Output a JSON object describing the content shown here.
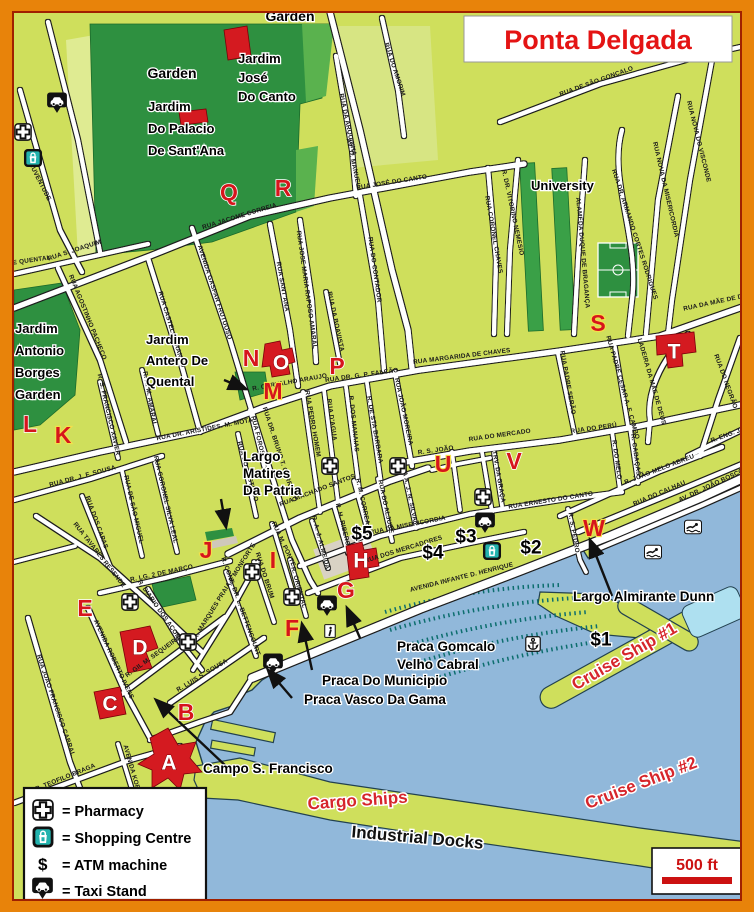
{
  "title": {
    "text": "Ponta Delgada"
  },
  "scale": {
    "text": "500 ft"
  },
  "legend": {
    "dollar": "$",
    "rows": [
      {
        "icon": "pharmacy",
        "text": "= Pharmacy"
      },
      {
        "icon": "shopping",
        "text": "= Shopping Centre"
      },
      {
        "icon": "atm",
        "text": "= ATM machine"
      },
      {
        "icon": "taxi",
        "text": "= Taxi Stand"
      }
    ]
  },
  "colors": {
    "frame_orange": "#e8830a",
    "land": "#cfdf5c",
    "water": "#91b8da",
    "park_dark": "#2e9040",
    "road": "#ffffff",
    "marker_red": "#d6151c",
    "title_red": "#e41414",
    "boat_teal": "#0d6e6e"
  },
  "parks": {
    "garden_top": "Garden",
    "garden_west": "Garden",
    "joseCanto": [
      "Jardim",
      "José",
      "Do Canto"
    ],
    "santana": [
      "Jardim",
      "Do Palacio",
      "De Sant'Ana"
    ],
    "borges": [
      "Jardim",
      "Antonio",
      "Borges",
      "Garden"
    ],
    "antero": [
      "Jardim",
      "Antero De",
      "Quental"
    ],
    "university": "University"
  },
  "places": {
    "matires": [
      "Largo",
      "Matires",
      "Da Patria"
    ],
    "gomcalo": [
      "Praca Gomcalo",
      "Velho Cabral"
    ],
    "municipio": "Praca Do Municipio",
    "vasco": "Praca Vasco Da Gama",
    "campo": "Campo S. Francisco",
    "dunn": "Largo Almirante Dunn",
    "cargo": "Cargo Ships",
    "industrial": "Industrial Docks",
    "cruise1": "Cruise Ship #1",
    "cruise2": "Cruise Ship #2"
  },
  "markers": [
    {
      "t": "A",
      "x": 169,
      "y": 763,
      "s": "w"
    },
    {
      "t": "B",
      "x": 186,
      "y": 712,
      "s": "r"
    },
    {
      "t": "C",
      "x": 110,
      "y": 704,
      "s": "w"
    },
    {
      "t": "D",
      "x": 140,
      "y": 648,
      "s": "w"
    },
    {
      "t": "E",
      "x": 85,
      "y": 608,
      "s": "r"
    },
    {
      "t": "F",
      "x": 292,
      "y": 628,
      "s": "y"
    },
    {
      "t": "G",
      "x": 346,
      "y": 590,
      "s": "r"
    },
    {
      "t": "H",
      "x": 361,
      "y": 561,
      "s": "w"
    },
    {
      "t": "I",
      "x": 273,
      "y": 560,
      "s": "y"
    },
    {
      "t": "J",
      "x": 206,
      "y": 550,
      "s": "y"
    },
    {
      "t": "K",
      "x": 63,
      "y": 435,
      "s": "y"
    },
    {
      "t": "L",
      "x": 30,
      "y": 424,
      "s": "r"
    },
    {
      "t": "M",
      "x": 273,
      "y": 391,
      "s": "y"
    },
    {
      "t": "N",
      "x": 251,
      "y": 358,
      "s": "r"
    },
    {
      "t": "O",
      "x": 281,
      "y": 363,
      "s": "w"
    },
    {
      "t": "P",
      "x": 337,
      "y": 366,
      "s": "r"
    },
    {
      "t": "Q",
      "x": 229,
      "y": 192,
      "s": "r"
    },
    {
      "t": "R",
      "x": 283,
      "y": 188,
      "s": "r"
    },
    {
      "t": "S",
      "x": 598,
      "y": 323,
      "s": "y"
    },
    {
      "t": "T",
      "x": 674,
      "y": 352,
      "s": "w"
    },
    {
      "t": "U",
      "x": 443,
      "y": 464,
      "s": "y"
    },
    {
      "t": "V",
      "x": 514,
      "y": 461,
      "s": "r"
    },
    {
      "t": "W",
      "x": 594,
      "y": 528,
      "s": "y"
    }
  ],
  "atms": [
    {
      "t": "$1",
      "x": 601,
      "y": 640
    },
    {
      "t": "$2",
      "x": 531,
      "y": 548
    },
    {
      "t": "$3",
      "x": 466,
      "y": 537
    },
    {
      "t": "$4",
      "x": 433,
      "y": 553
    },
    {
      "t": "$5",
      "x": 362,
      "y": 534
    }
  ],
  "streets": [
    {
      "t": "AV. D. MANUEL I",
      "x": 352,
      "y": 165,
      "a": 78
    },
    {
      "t": "DA JUVENTUDE",
      "x": 36,
      "y": 178,
      "a": 63
    },
    {
      "t": "E QUENTAL",
      "x": 32,
      "y": 262,
      "a": -8
    },
    {
      "t": "RUA S. JOAQUIM",
      "x": 75,
      "y": 252,
      "a": -18
    },
    {
      "t": "RUA JACOME CORREIA",
      "x": 240,
      "y": 218,
      "a": -17
    },
    {
      "t": "RUA JOSÉ DO CANTO",
      "x": 392,
      "y": 184,
      "a": -9
    },
    {
      "t": "RUA CASTELO BRANCO",
      "x": 170,
      "y": 330,
      "a": 73
    },
    {
      "t": "AVENIDA GASPAR FRUTUOSO",
      "x": 213,
      "y": 293,
      "a": 72
    },
    {
      "t": "RUA SANT'ANA",
      "x": 281,
      "y": 287,
      "a": 80
    },
    {
      "t": "RUA JOSE MARIA RAPOSO AMARAL",
      "x": 305,
      "y": 290,
      "a": 82
    },
    {
      "t": "RUA DA BOAVISTA",
      "x": 334,
      "y": 322,
      "a": 78
    },
    {
      "t": "RUA DO CONTADOR",
      "x": 373,
      "y": 270,
      "a": 82
    },
    {
      "t": "RUA DA ARQUINHA",
      "x": 346,
      "y": 125,
      "a": 78
    },
    {
      "t": "RUA DO AMORIM",
      "x": 393,
      "y": 70,
      "a": 72
    },
    {
      "t": "RUA DE SÃO GONÇALO",
      "x": 597,
      "y": 83,
      "a": -20
    },
    {
      "t": "RUA NOVA DO VISCONDE",
      "x": 697,
      "y": 142,
      "a": 76
    },
    {
      "t": "RUA NOVA DA MISERICORDIA",
      "x": 664,
      "y": 190,
      "a": 77
    },
    {
      "t": "RUA DR. ARMANDO CORTES RODRIGUES",
      "x": 633,
      "y": 235,
      "a": 72
    },
    {
      "t": "R. DR. VITORINO NEMESIO",
      "x": 511,
      "y": 213,
      "a": 78
    },
    {
      "t": "ALAMEDA DUQUE DE BRAGANÇA",
      "x": 581,
      "y": 253,
      "a": 85
    },
    {
      "t": "RUA CORONEL CHAVES",
      "x": 492,
      "y": 235,
      "a": 80
    },
    {
      "t": "RUA MARGARIDA DE CHAVES",
      "x": 462,
      "y": 358,
      "a": -7
    },
    {
      "t": "RUA DR. G. P. FALCÃO",
      "x": 362,
      "y": 377,
      "a": -8
    },
    {
      "t": "R. CARVALHO ARAUJO",
      "x": 290,
      "y": 384,
      "a": -10
    },
    {
      "t": "RUA JOÃO MOREIRA",
      "x": 402,
      "y": 412,
      "a": 78
    },
    {
      "t": "RUA PEDRO HOMEM",
      "x": 311,
      "y": 424,
      "a": 80
    },
    {
      "t": "RUA D'AGUA",
      "x": 330,
      "y": 420,
      "a": 82
    },
    {
      "t": "R. DOS MANAIAS",
      "x": 352,
      "y": 424,
      "a": 84
    },
    {
      "t": "R. DE STA BARBARA",
      "x": 373,
      "y": 430,
      "a": 80
    },
    {
      "t": "RUA FOROS",
      "x": 256,
      "y": 436,
      "a": 76
    },
    {
      "t": "RUA DO CASTILHO",
      "x": 246,
      "y": 472,
      "a": 74
    },
    {
      "t": "RUA DR. BRUNO T. CARREIRO",
      "x": 278,
      "y": 455,
      "a": 72
    },
    {
      "t": "RUA DR. ARISTIDES. M. MOTA",
      "x": 205,
      "y": 431,
      "a": -11
    },
    {
      "t": "R. A. M. AMARAL",
      "x": 148,
      "y": 399,
      "a": 80
    },
    {
      "t": "R. S. FRANCISCO XAVIER",
      "x": 107,
      "y": 415,
      "a": 77
    },
    {
      "t": "RUA AGOSTINHO PACHECO",
      "x": 86,
      "y": 318,
      "a": 68
    },
    {
      "t": "RUA DR. J. F. SOUSA",
      "x": 83,
      "y": 478,
      "a": -15
    },
    {
      "t": "RUA DOS CAPAS",
      "x": 95,
      "y": 523,
      "a": 70
    },
    {
      "t": "RUA TAVARES RESENDE",
      "x": 98,
      "y": 556,
      "a": 52
    },
    {
      "t": "RUA DE SÃO MIGUEL",
      "x": 132,
      "y": 510,
      "a": 77
    },
    {
      "t": "RUA CORONEL SILVA LEAL",
      "x": 164,
      "y": 500,
      "a": 77
    },
    {
      "t": "R. LG. 2 DE MARÇO",
      "x": 162,
      "y": 575,
      "a": -12
    },
    {
      "t": "R. DIARIO DOS AÇORES",
      "x": 160,
      "y": 614,
      "a": 55
    },
    {
      "t": "R. MARQUES PRAIA E MONFORTE",
      "x": 226,
      "y": 592,
      "a": -58
    },
    {
      "t": "RUA M. PONTE",
      "x": 282,
      "y": 545,
      "a": 65
    },
    {
      "t": "RUA DO BRUM",
      "x": 263,
      "y": 576,
      "a": 72
    },
    {
      "t": "R. ORIENTAL",
      "x": 297,
      "y": 588,
      "a": 74
    },
    {
      "t": "R. CONS. DR. L. BETTENCOURT",
      "x": 239,
      "y": 607,
      "a": 70
    },
    {
      "t": "RUA MACHADO SANTOS",
      "x": 318,
      "y": 492,
      "a": -21
    },
    {
      "t": "R. M. CORREA",
      "x": 361,
      "y": 502,
      "a": 78
    },
    {
      "t": "R. H. RIBERO",
      "x": 341,
      "y": 525,
      "a": 76
    },
    {
      "t": "R. A. J. ALMEIDA",
      "x": 319,
      "y": 543,
      "a": 75
    },
    {
      "t": "RUA DO ALJUBE",
      "x": 384,
      "y": 507,
      "a": 78
    },
    {
      "t": "RUA A. J. N. SILVA",
      "x": 407,
      "y": 492,
      "a": 78
    },
    {
      "t": "RUA DA MISERICORDIA",
      "x": 408,
      "y": 527,
      "a": -11
    },
    {
      "t": "RUA DOS MERCADORES",
      "x": 404,
      "y": 551,
      "a": -17
    },
    {
      "t": "AVENIDA INFANTE D. HENRIQUE",
      "x": 462,
      "y": 579,
      "a": -14
    },
    {
      "t": "R. S. JOÃO",
      "x": 436,
      "y": 452,
      "a": -8
    },
    {
      "t": "RUA DO MERCADO",
      "x": 500,
      "y": 437,
      "a": -8
    },
    {
      "t": "RUA DO PERÚ",
      "x": 594,
      "y": 430,
      "a": -8
    },
    {
      "t": "TRV. DA GRAÇA",
      "x": 497,
      "y": 477,
      "a": 80
    },
    {
      "t": "RUA ERNESTO DO CANTO",
      "x": 551,
      "y": 502,
      "a": -9
    },
    {
      "t": "R. S. PEDRO",
      "x": 572,
      "y": 533,
      "a": 80
    },
    {
      "t": "R. DO MELO",
      "x": 615,
      "y": 460,
      "a": 82
    },
    {
      "t": "R. CABAÇAS",
      "x": 634,
      "y": 455,
      "a": 82
    },
    {
      "t": "R. JOÃO MELO ABREU",
      "x": 660,
      "y": 471,
      "a": -21
    },
    {
      "t": "RUA DO CALHAU",
      "x": 660,
      "y": 495,
      "a": -23
    },
    {
      "t": "AV. DR. JOÃO BOSCO",
      "x": 712,
      "y": 487,
      "a": -25
    },
    {
      "t": "R. ENG. J.",
      "x": 727,
      "y": 437,
      "a": -20
    },
    {
      "t": "RUA DO NEGRÃO",
      "x": 724,
      "y": 382,
      "a": 70
    },
    {
      "t": "LADEIRA DA MÃE DE DEUS",
      "x": 650,
      "y": 382,
      "a": 74
    },
    {
      "t": "RUA DA MÃE DE DEUS",
      "x": 720,
      "y": 303,
      "a": -12
    },
    {
      "t": "RUA PADRE SERÃO",
      "x": 566,
      "y": 383,
      "a": 80
    },
    {
      "t": "RUA PADRE CESAR A. F. CAMBO",
      "x": 621,
      "y": 388,
      "a": 74
    },
    {
      "t": "AVENIDA ROBERTO IVENS",
      "x": 112,
      "y": 660,
      "a": 65
    },
    {
      "t": "R. GIL M. SEQUEIRA",
      "x": 154,
      "y": 658,
      "a": -36
    },
    {
      "t": "R. LUIS S. SOUSA",
      "x": 203,
      "y": 677,
      "a": -31
    },
    {
      "t": "RUA JOÃO FRANCISCO CABRAL",
      "x": 54,
      "y": 706,
      "a": 71
    },
    {
      "t": "R. TEOFILO BRAGA",
      "x": 66,
      "y": 779,
      "a": -22
    },
    {
      "t": "AVENIDA KOPKE",
      "x": 131,
      "y": 772,
      "a": 74
    }
  ],
  "icons": [
    {
      "k": "taxi",
      "x": 57,
      "y": 103
    },
    {
      "k": "pharmacy",
      "x": 23,
      "y": 132
    },
    {
      "k": "shopping",
      "x": 33,
      "y": 158
    },
    {
      "k": "pharmacy",
      "x": 330,
      "y": 466
    },
    {
      "k": "pharmacy",
      "x": 398,
      "y": 466
    },
    {
      "k": "pharmacy",
      "x": 483,
      "y": 497
    },
    {
      "k": "taxi",
      "x": 485,
      "y": 523
    },
    {
      "k": "shopping",
      "x": 492,
      "y": 551
    },
    {
      "k": "pharmacy",
      "x": 252,
      "y": 572
    },
    {
      "k": "pharmacy",
      "x": 292,
      "y": 597
    },
    {
      "k": "taxi",
      "x": 327,
      "y": 606
    },
    {
      "k": "info",
      "x": 330,
      "y": 631
    },
    {
      "k": "taxi",
      "x": 273,
      "y": 664
    },
    {
      "k": "pharmacy",
      "x": 130,
      "y": 602
    },
    {
      "k": "pharmacy",
      "x": 188,
      "y": 642
    },
    {
      "k": "anchor",
      "x": 533,
      "y": 644
    },
    {
      "k": "swim",
      "x": 693,
      "y": 527
    },
    {
      "k": "swim",
      "x": 653,
      "y": 552
    }
  ]
}
